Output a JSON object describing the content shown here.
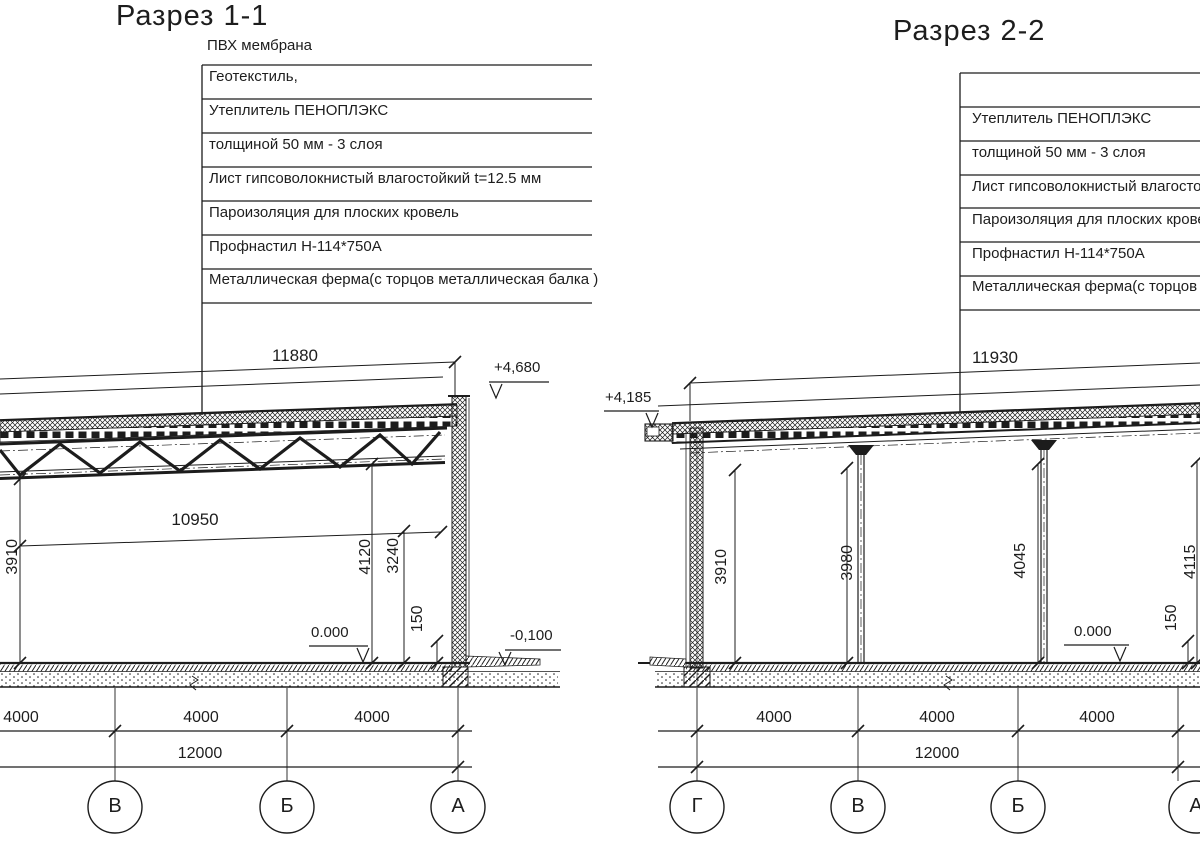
{
  "colors": {
    "ink": "#1c1c1c",
    "paper": "#ffffff"
  },
  "sections": {
    "left": {
      "title": "Разрез 1-1",
      "top_note": "ПВХ мембрана",
      "callout_rows": [
        "Геотекстиль,",
        "Утеплитель ПЕНОПЛЭКС",
        "толщиной 50 мм - 3 слоя",
        "Лист гипсоволокнистый влагостойкий t=12.5 мм",
        "Пароизоляция для плоских кровель",
        "Профнастил Н-114*750А",
        "Металлическая ферма(с торцов металлическая балка )"
      ],
      "dims": {
        "span_top": "11880",
        "clear_span": "10950",
        "height_left": "3910",
        "height_mid": "4120",
        "height_right": "3240",
        "plinth": "150"
      },
      "levels": {
        "roof": "+4,680",
        "floor": "0.000",
        "ground": "-0,100"
      },
      "axis_dims": [
        "4000",
        "4000",
        "4000"
      ],
      "total_dim": "12000",
      "grid_labels": [
        "В",
        "Б",
        "А"
      ]
    },
    "right": {
      "title": "Разрез 2-2",
      "callout_rows": [
        "",
        "Утеплитель ПЕНОПЛЭКС",
        "толщиной 50 мм - 3 слоя",
        "Лист гипсоволокнистый влагостой",
        "Пароизоляция для плоских кровел",
        "Профнастил Н-114*750А",
        "Металлическая ферма(с торцов м"
      ],
      "dims": {
        "span_top": "11930",
        "height_1": "3910",
        "height_2": "3980",
        "height_3": "4045",
        "height_4": "4115",
        "plinth": "150"
      },
      "levels": {
        "roof": "+4,185",
        "floor": "0.000"
      },
      "axis_dims": [
        "4000",
        "4000",
        "4000"
      ],
      "total_dim": "12000",
      "grid_labels": [
        "Г",
        "В",
        "Б",
        "А"
      ]
    }
  }
}
